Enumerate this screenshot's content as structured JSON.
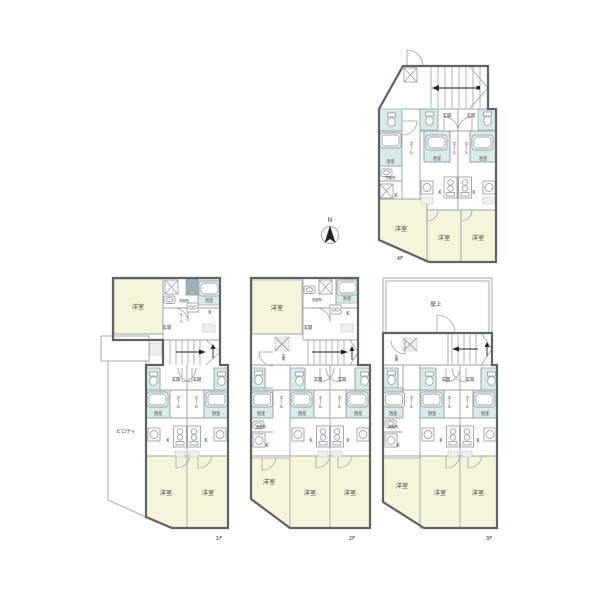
{
  "colors": {
    "bg": "#ffffff",
    "wall": "#5c6466",
    "thin": "#98a2a5",
    "cream": "#f7f4dc",
    "blue": "#d9eaea",
    "dark_fixture": "#9fb4b8",
    "text": "#3b3b3b"
  },
  "compass": {
    "north": "N"
  },
  "room_names": {
    "western_room": "洋室",
    "bath": "浴室",
    "washroom": "洗面所",
    "kitchen": "K",
    "hall": "ホール",
    "entrance": "玄関",
    "piloti": "ピロティ",
    "rooftop": "屋上"
  },
  "floors": {
    "f1": {
      "label": "1F"
    },
    "f2": {
      "label": "2F"
    },
    "f3": {
      "label": "3F"
    },
    "f4": {
      "label": "4F"
    }
  }
}
